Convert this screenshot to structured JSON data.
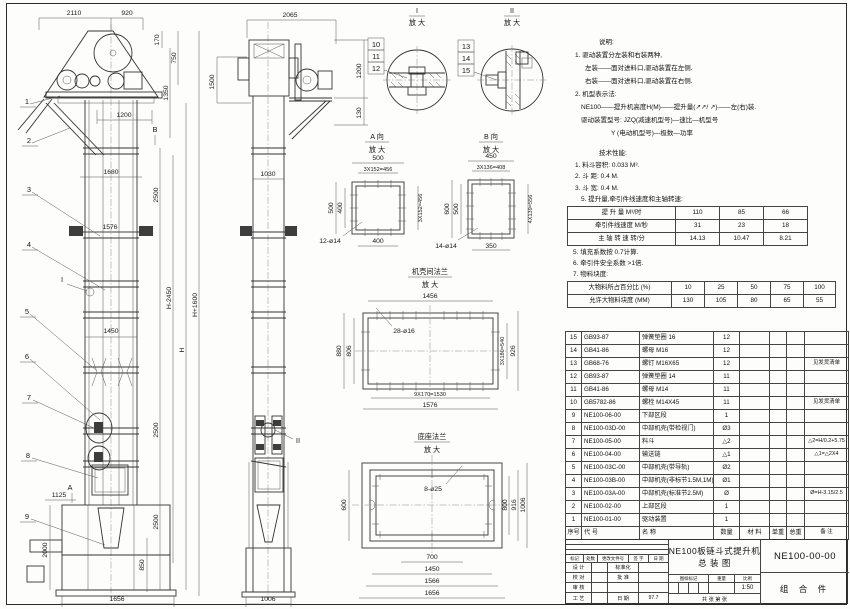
{
  "front": {
    "dims": {
      "top1": "2110",
      "top2": "920",
      "v170": "170",
      "v750": "750",
      "v1350": "1350",
      "w1200": "1200",
      "w1680": "1680",
      "w1576": "1576",
      "w1450": "1450",
      "w1125": "1125",
      "v2000": "2000",
      "v850": "850",
      "w1656": "1656",
      "seg2500a": "2500",
      "seg2500b": "2500",
      "seg2500c": "2500",
      "hminus": "H-2450",
      "h": "H",
      "hplus": "H+1600"
    },
    "leaders": [
      "1",
      "2",
      "3",
      "4",
      "5",
      "6",
      "7",
      "8",
      "9"
    ],
    "marker_i": "I",
    "marker_a": "A",
    "marker_b": "B"
  },
  "side": {
    "dims": {
      "top": "2065",
      "left1500": "1500",
      "right1200": "1200",
      "right130": "130",
      "mid1030": "1030",
      "bot1006": "1006"
    },
    "marker_ii": "II"
  },
  "detail1": {
    "title": "I",
    "sub": "放 大",
    "leaders": [
      "10",
      "11",
      "12"
    ]
  },
  "detail2": {
    "title": "II",
    "sub": "放 大",
    "leaders": [
      "13",
      "14",
      "15"
    ]
  },
  "viewA": {
    "title": "A 向",
    "sub": "放 大",
    "dims": {
      "top": "500",
      "topin": "3X152=456",
      "left": "500",
      "leftin": "400",
      "right": "3X152=456",
      "bottom": "400",
      "holes": "12-ø14"
    }
  },
  "viewB": {
    "title": "B 向",
    "sub": "放 大",
    "dims": {
      "top": "450",
      "topin": "3X136=408",
      "left": "600",
      "leftin": "500",
      "right": "4X139=556",
      "bottom": "350",
      "holes": "14-ø14"
    }
  },
  "flange": {
    "title": "机壳间法兰",
    "sub": "放 大",
    "dims": {
      "top": "1456",
      "holes": "28-ø16",
      "left": "880",
      "leftin": "806",
      "rightin": "3X180=540",
      "right": "926",
      "botin": "9X170=1530",
      "bot": "1576"
    }
  },
  "baseflange": {
    "title": "底座法兰",
    "sub": "放 大",
    "dims": {
      "holes": "8-ø25",
      "left": "600",
      "r800": "800",
      "r916": "916",
      "r1006": "1006",
      "b700": "700",
      "b1450": "1450",
      "b1566": "1566",
      "b1656": "1656"
    }
  },
  "notes": {
    "h": "说明:",
    "l1": "1. 驱动装置分左装和右装两种,",
    "l2": "左装——面对进料口,驱动装置在左侧.",
    "l3": "右装——面对进料口,驱动装置在右侧.",
    "l4": "2. 机型表示法:",
    "l5": "NE100——提升机高度H(M)——提升量(↗↗/ ↗)——左(右)装.",
    "l6": "驱动装置型号: JZQ(减速机型号)—速比—机型号",
    "l7": "Y (电动机型号)—极数—功率"
  },
  "perf": {
    "h": "技术性能:",
    "i1": "1. 料斗容积: 0.033 M³.",
    "i2": "2. 斗    距: 0.4 M.",
    "i3": "3. 斗    宽: 0.4 M.",
    "i4": "5. 提升量,牵引件线速度和主轴转速:",
    "j1": "5. 填充系数按 0.7计算.",
    "j2": "6. 牵引件安全系数 >1倍.",
    "j3": "7. 物料块度:"
  },
  "spec_rows": [
    [
      "提 升 量    M³/时",
      "110",
      "85",
      "66"
    ],
    [
      "牵引件线速度  M/秒",
      "31",
      "23",
      "18"
    ],
    [
      "主 轴 转 速   转/分",
      "14.13",
      "10.47",
      "8.21"
    ]
  ],
  "size_rows": [
    [
      "大物料所占百分比 (%)",
      "10",
      "25",
      "50",
      "75",
      "100"
    ],
    [
      "允许大物料块度 (MM)",
      "130",
      "105",
      "80",
      "65",
      "55"
    ]
  ],
  "parts_rows": [
    [
      "15",
      "GB93-87",
      "弹簧垫圈 16",
      "12",
      "",
      "",
      "",
      ""
    ],
    [
      "14",
      "GB41-86",
      "螺母 M16",
      "12",
      "",
      "",
      "",
      ""
    ],
    [
      "13",
      "GB68-76",
      "螺钉 M16X65",
      "12",
      "",
      "",
      "",
      "见发货清单"
    ],
    [
      "12",
      "GB93-87",
      "弹簧垫圈 14",
      "11",
      "",
      "",
      "",
      ""
    ],
    [
      "11",
      "GB41-86",
      "螺母 M14",
      "11",
      "",
      "",
      "",
      ""
    ],
    [
      "10",
      "GB5782-86",
      "螺栓 M14X45",
      "11",
      "",
      "",
      "",
      "见发货清单"
    ],
    [
      "9",
      "NE100-06-00",
      "下部区段",
      "1",
      "",
      "",
      "",
      ""
    ],
    [
      "8",
      "NE100-03D-00",
      "中部机壳(带检视门)",
      "Ø3",
      "",
      "",
      "",
      ""
    ],
    [
      "7",
      "NE100-05-00",
      "料斗",
      "△2",
      "",
      "",
      "",
      "△2=H/0.2+5.75"
    ],
    [
      "6",
      "NE100-04-00",
      "输送链",
      "△1",
      "",
      "",
      "",
      "△1=△2X4"
    ],
    [
      "5",
      "NE100-03C-00",
      "中部机壳(带导轨)",
      "Ø2",
      "",
      "",
      "",
      ""
    ],
    [
      "4",
      "NE100-03B-00",
      "中部机壳(非标节1.5M,1M)",
      "Ø1",
      "",
      "",
      "",
      ""
    ],
    [
      "3",
      "NE100-03A-00",
      "中部机壳(标准节2.5M)",
      "Ø",
      "",
      "",
      "",
      "Ø=H-3.15/2.5"
    ],
    [
      "2",
      "NE100-02-00",
      "上部区段",
      "1",
      "",
      "",
      "",
      ""
    ],
    [
      "1",
      "NE100-01-00",
      "驱动装置",
      "1",
      "",
      "",
      "",
      ""
    ],
    [
      "序号",
      "代  号",
      "名  称",
      "数量",
      "材  料",
      "单重",
      "总重",
      "备  注"
    ]
  ],
  "titleblock": {
    "rev": [
      "标记",
      "处数",
      "更改文件号",
      "签 字",
      "日 期"
    ],
    "r1c1": "设 计",
    "r1c3": "标准化",
    "r2c1": "校 对",
    "r2c3": "批 准",
    "r3c1": "审 核",
    "r3c3": "",
    "r4c1": "工 艺",
    "r4c3": "日 期",
    "date": "97.7",
    "title1": "NE100板链斗式提升机",
    "title2": "总  装  图",
    "stamp1": "图样标记",
    "stamp2": "重量",
    "stamp3": "比例",
    "scale": "1:50",
    "sheets": "共  张  第  张",
    "dwg_no": "NE100-00-00",
    "part_type": "组 合 件"
  }
}
